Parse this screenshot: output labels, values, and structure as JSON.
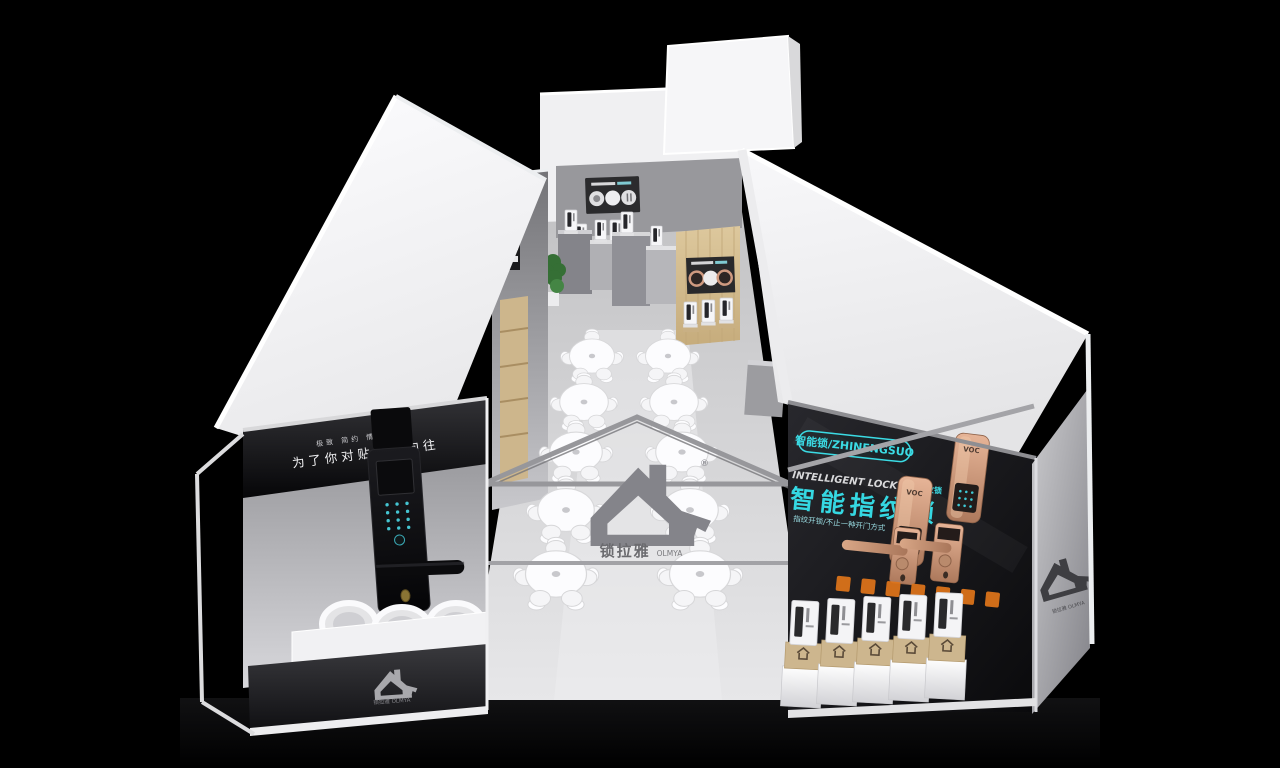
{
  "scene": {
    "description": "3D render of a smart-lock brand exhibition booth viewed from above",
    "background_color": "#000000"
  },
  "brand": {
    "name_cn": "锁拉雅",
    "name_en": "OLMYA",
    "full": "锁拉雅 OLMYA",
    "registered_mark": "®"
  },
  "left_wall_panel": {
    "tagline_small": "极致 简约 情怀 科技",
    "tagline_main": "为了你对贴心的向往"
  },
  "right_wall_panel": {
    "badge_label": "智能锁/ZHINENGSUO",
    "heading_en": "INTELLIGENT LOCK",
    "heading_cn_inline": "智能指纹锁",
    "headline_cn": "智能指纹锁",
    "tagline": "指纹开锁/不止一种开门方式",
    "lock_brand": "VOC"
  },
  "furniture": {
    "round_tables": 10,
    "product_pedestals": 5,
    "giant_lock_displays": 1
  },
  "colors": {
    "accent_cyan": "#38d9e3",
    "rose_gold": "#c48b6d",
    "kraft_box": "#cdb68e",
    "orange_accent": "#e0751a",
    "roof_white": "#f4f4f6",
    "floor_gray": "#d9d9db",
    "wood": "#d6c095"
  }
}
